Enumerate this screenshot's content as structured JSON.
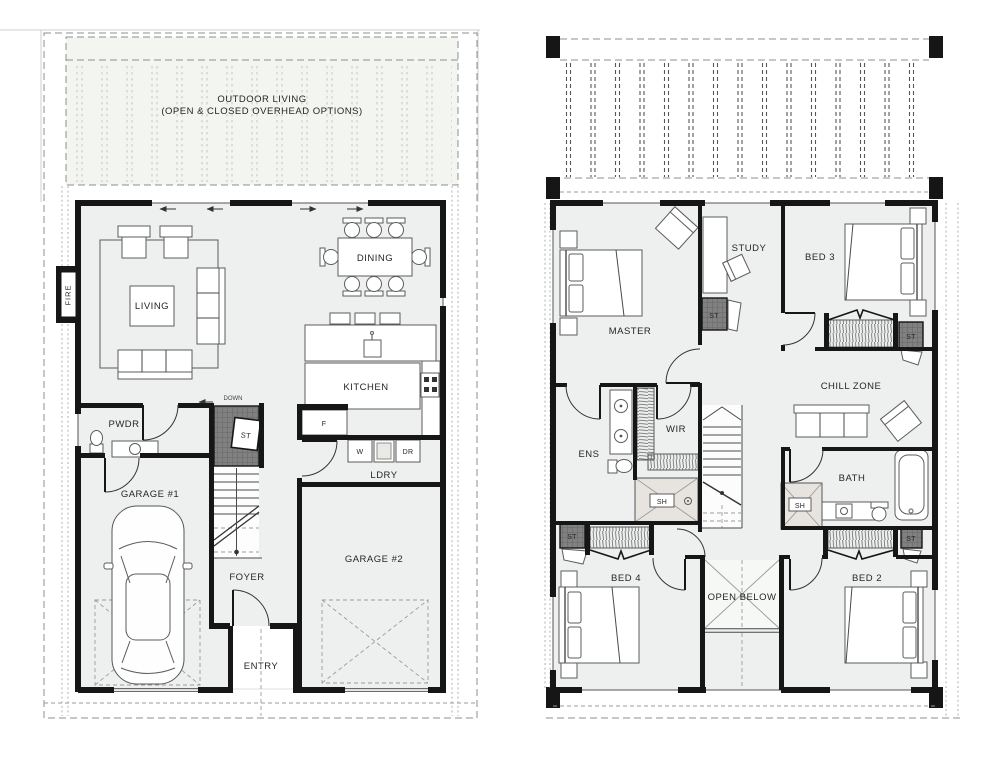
{
  "ground_floor": {
    "outdoor_living": {
      "line1": "OUTDOOR LIVING",
      "line2": "(OPEN & CLOSED OVERHEAD OPTIONS)"
    },
    "rooms": {
      "living": "LIVING",
      "dining": "DINING",
      "kitchen": "KITCHEN",
      "powder": "PWDR",
      "laundry": "LDRY",
      "foyer": "FOYER",
      "entry": "ENTRY",
      "garage_1": "GARAGE #1",
      "garage_2": "GARAGE #2"
    },
    "fixtures": {
      "fireplace": "FIRE",
      "storage": "ST",
      "fridge": "F",
      "washer": "W",
      "dryer": "DR",
      "stair_direction": "DOWN"
    }
  },
  "first_floor": {
    "rooms": {
      "master": "MASTER",
      "study": "STUDY",
      "bed_2": "BED 2",
      "bed_3": "BED 3",
      "bed_4": "BED 4",
      "chill_zone": "CHILL ZONE",
      "ensuite": "ENS",
      "walk_in_robe": "WIR",
      "bath": "BATH",
      "open_below": "OPEN BELOW"
    },
    "fixtures": {
      "storage": "ST",
      "shower": "SH"
    }
  },
  "colors": {
    "wall": "#161616",
    "floor": "#edf0ee",
    "outdoor_floor": "#f3f5f1",
    "shower_floor": "#e7e4df",
    "storage_fill": "#7e7e7e",
    "dash": "#999999"
  }
}
